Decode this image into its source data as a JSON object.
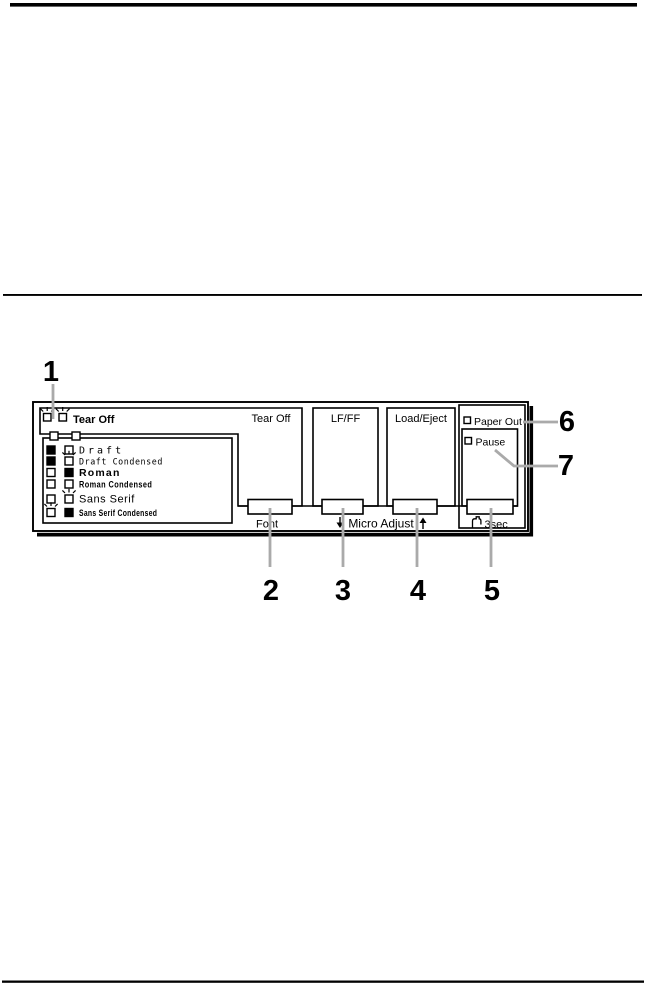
{
  "callouts": {
    "c1": "1",
    "c2": "2",
    "c3": "3",
    "c4": "4",
    "c5": "5",
    "c6": "6",
    "c7": "7"
  },
  "panel": {
    "tear_off_indicator_label": "Tear Off",
    "tear_off_leds": [
      "flashing",
      "flashing"
    ],
    "font_table": {
      "rows": [
        {
          "label": "Draft",
          "led1": "on",
          "led2": "off"
        },
        {
          "label": "Draft Condensed",
          "led1": "on",
          "led2": "flashing"
        },
        {
          "label": "Roman",
          "led1": "off",
          "led2": "on"
        },
        {
          "label": "Roman Condensed",
          "led1": "off",
          "led2": "off"
        },
        {
          "label": "Sans Serif",
          "led1": "off",
          "led2": "flashing"
        },
        {
          "label": "Sans Serif Condensed",
          "led1": "flashing",
          "led2": "on"
        }
      ]
    },
    "buttons": {
      "tear_off": "Tear Off",
      "lf_ff": "LF/FF",
      "load_eject": "Load/Eject"
    },
    "button_sublabels": {
      "font": "Font",
      "micro_adjust": "Micro Adjust",
      "hold_duration": "3sec"
    },
    "leds": {
      "paper_out": "Paper Out",
      "pause": "Pause"
    }
  },
  "colors": {
    "ink": "#000000",
    "callout_line": "#aaaaaa"
  }
}
